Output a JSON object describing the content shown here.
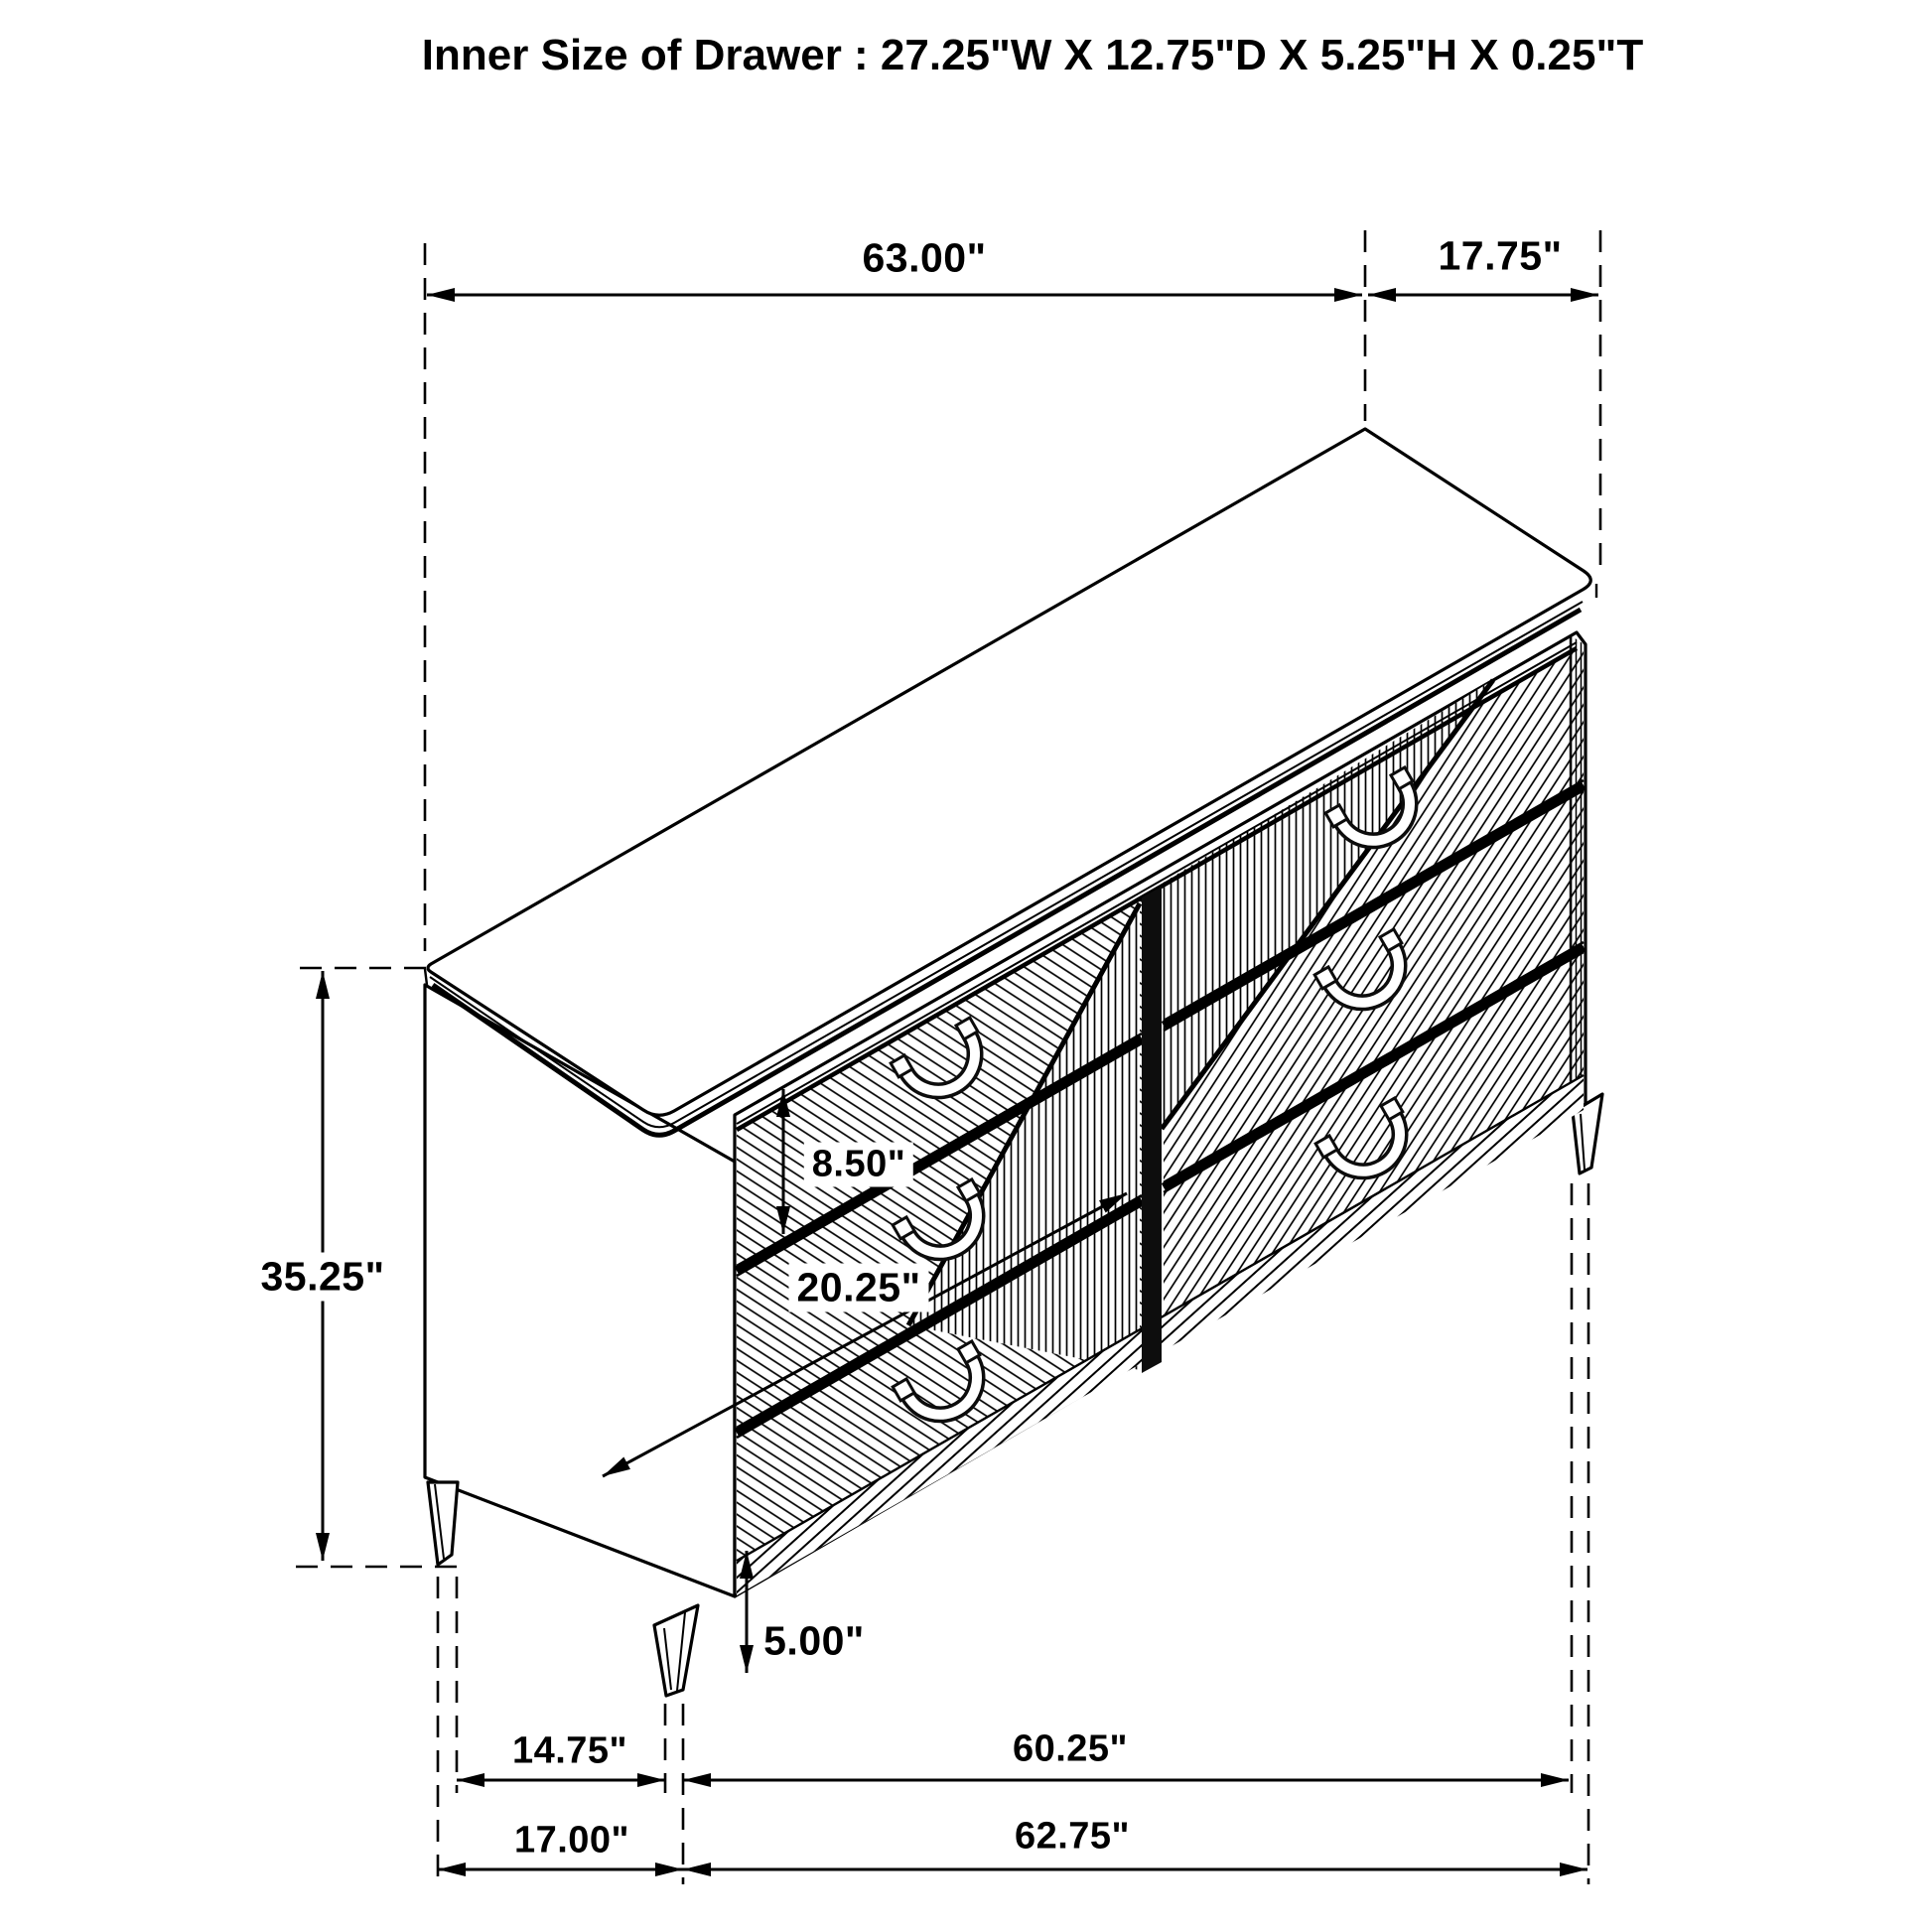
{
  "title": "Inner Size of Drawer : 27.25\"W X 12.75\"D X 5.25\"H X 0.25\"T",
  "dimensions": {
    "top_width": "63.00\"",
    "top_depth": "17.75\"",
    "overall_height": "35.25\"",
    "drawer_front_height": "8.50\"",
    "drawer_front_width": "20.25\"",
    "leg_height": "5.00\"",
    "left_leg_offset": "14.75\"",
    "front_leg_span": "60.25\"",
    "left_footprint": "17.00\"",
    "front_footprint": "62.75\""
  },
  "drawing": {
    "object": "6-drawer dresser, isometric line drawing",
    "drawer_banks": 2,
    "drawers_per_bank": 3,
    "handle_style": "horseshoe pull",
    "legs_visible": 3
  },
  "colors": {
    "line": "#000000",
    "background": "#ffffff"
  }
}
